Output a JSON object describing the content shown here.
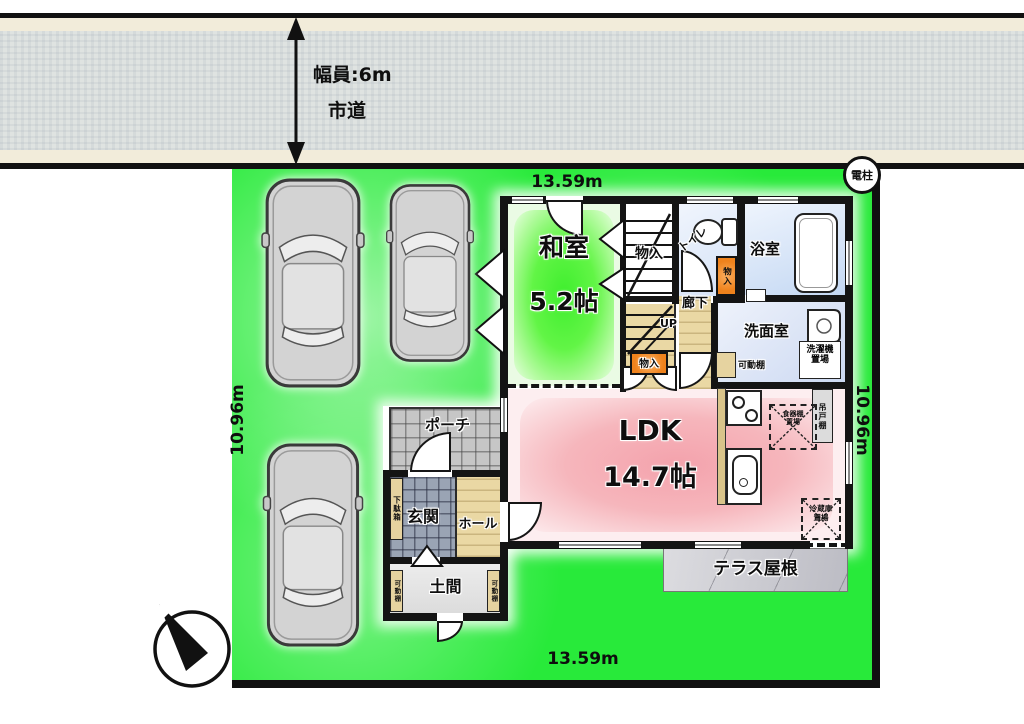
{
  "road": {
    "width_label": "幅員:6m",
    "name_label": "市道"
  },
  "dimensions": {
    "top": "13.59m",
    "bottom": "13.59m",
    "left": "10.96m",
    "right": "10.96m"
  },
  "site": {
    "utility_pole_label": "電柱"
  },
  "rooms": {
    "washitsu_name": "和室",
    "washitsu_size": "5.2帖",
    "ldk_name": "LDK",
    "ldk_size": "14.7帖",
    "genkan": "玄関",
    "hall": "ホール",
    "porch": "ポーチ",
    "doma": "土間",
    "corridor": "廊下",
    "toilet": "トイレ",
    "bath": "浴室",
    "washroom": "洗面室",
    "stairs_up_label": "UP"
  },
  "closets": {
    "monoire_stairs": "物入",
    "monoire_under": "物入",
    "monoire_hall": "物入",
    "shoe_cabinet": "下駄箱",
    "movable_shelf_left": "可動棚",
    "movable_shelf_right": "可動棚",
    "movable_shelf_wash": "可動棚",
    "hanging_cupboard": "吊戸棚",
    "washer_space": "洗濯機置場",
    "fridge_space": "冷蔵庫置場",
    "cupboard_space": "食器棚置場"
  },
  "exterior": {
    "terrace_roof": "テラス屋根"
  },
  "colors": {
    "lot_green": "#28ea3a",
    "washitsu_green": "#4ef03a",
    "ldk_pink": "#f5aab2",
    "closet_orange": "#ef821c",
    "water_blue": "#cdddf4",
    "wood": "#ead8a4",
    "wall": "#141414"
  }
}
